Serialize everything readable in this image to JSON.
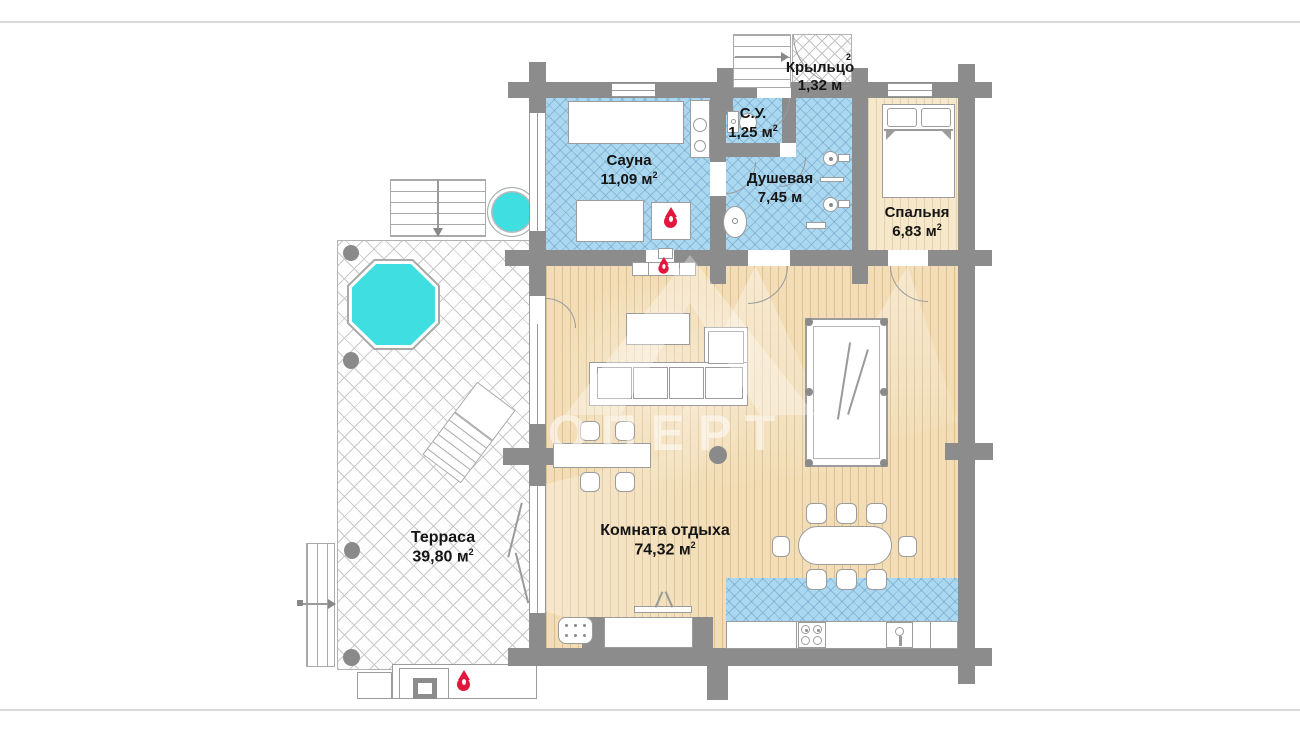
{
  "rooms": {
    "kryltso": {
      "name": "Крыльцо",
      "area": "1,32 м",
      "sup": "2"
    },
    "su": {
      "name": "С.У.",
      "area": "1,25 м",
      "sup": "2"
    },
    "sauna": {
      "name": "Сауна",
      "area": "11,09 м",
      "sup": "2"
    },
    "dushevaya": {
      "name": "Душевая",
      "area": "7,45 м",
      "sup": ""
    },
    "spalnya": {
      "name": "Спальня",
      "area": "6,83 м",
      "sup": "2"
    },
    "komnata": {
      "name": "Комната отдыха",
      "area": "74,32 м",
      "sup": "2"
    },
    "terrasa": {
      "name": "Терраса",
      "area": "39,80 м",
      "sup": "2"
    }
  },
  "watermark": {
    "letters": "ОПЕРТ"
  },
  "palette": {
    "wall": "#8c8c8c",
    "wet_floor_tile": "#aad8f0",
    "wood_floor": "#f2ddb6",
    "bedroom_floor": "#f6e8cb",
    "terrace_tile": "#fefefe",
    "water": "#3fdfe1",
    "flame": "#e3173d"
  },
  "icons": {
    "flame": "flame-icon (sauna stove, wall heater, bbq)",
    "water": "pool / hot-tub cyan fill"
  }
}
